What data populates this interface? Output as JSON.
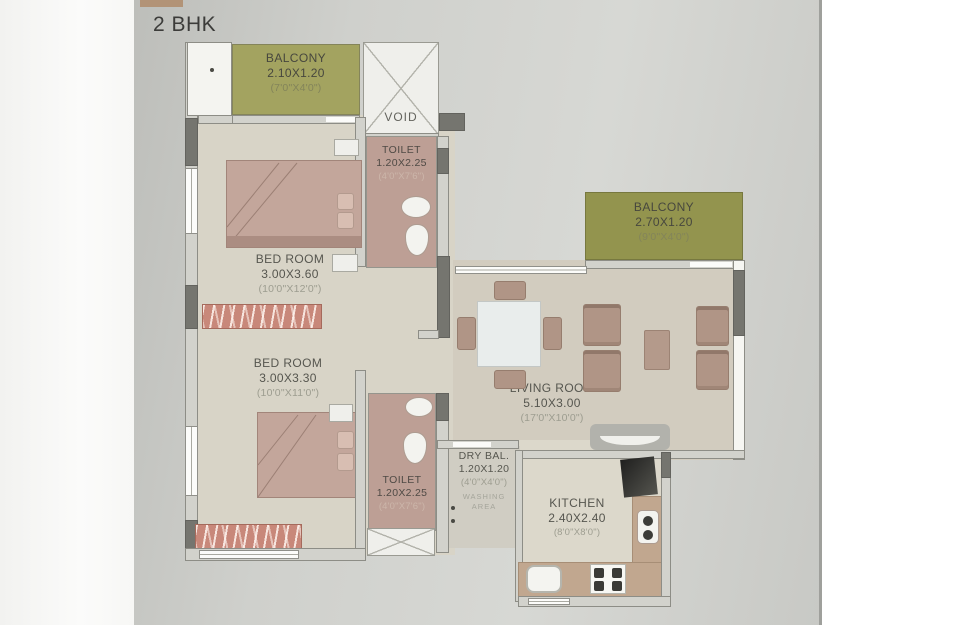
{
  "title": "2 BHK",
  "rooms": {
    "balcony_top": {
      "name": "BALCONY",
      "metric": "2.10X1.20",
      "imperial": "(7'0\"X4'0\")"
    },
    "void": {
      "name": "VOID"
    },
    "toilet_top": {
      "name": "TOILET",
      "metric": "1.20X2.25",
      "imperial": "(4'0\"X7'6\")"
    },
    "bedroom_top": {
      "name": "BED ROOM",
      "metric": "3.00X3.60",
      "imperial": "(10'0\"X12'0\")"
    },
    "bedroom_bottom": {
      "name": "BED ROOM",
      "metric": "3.00X3.30",
      "imperial": "(10'0\"X11'0\")"
    },
    "balcony_right": {
      "name": "BALCONY",
      "metric": "2.70X1.20",
      "imperial": "(9'0\"X4'0\")"
    },
    "living_room": {
      "name": "LIVING ROOM",
      "metric": "5.10X3.00",
      "imperial": "(17'0\"X10'0\")"
    },
    "toilet_bottom": {
      "name": "TOILET",
      "metric": "1.20X2.25",
      "imperial": "(4'0\"X7'6\")"
    },
    "dry_balcony": {
      "name": "DRY BAL.",
      "metric": "1.20X1.20",
      "imperial": "(4'0\"X4'0\")",
      "sub": "WASHING AREA"
    },
    "kitchen": {
      "name": "KITCHEN",
      "metric": "2.40X2.40",
      "imperial": "(8'0\"X8'0\")"
    }
  },
  "colors": {
    "page_gray": "#cbccc8",
    "title_strip_tan": "#b29377",
    "balcony_olive": "#a3a360",
    "balcony_olive_dark": "#93944e",
    "toilet_pink": "#bd9f95",
    "floor_beige": "#d8d4c7",
    "wardrobe_red": "#c8887a",
    "furniture_wood": "#b09586",
    "wall_dark": "#75756f"
  }
}
